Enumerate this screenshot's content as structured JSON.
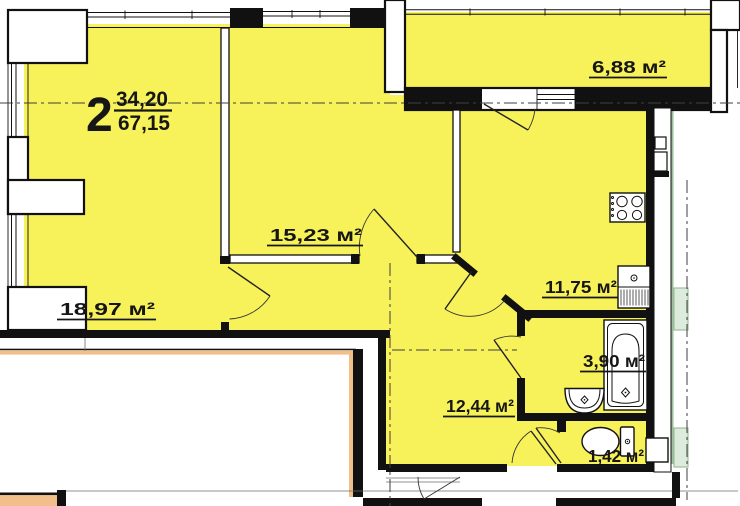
{
  "apartment": {
    "number": "2",
    "living_area": "34,20",
    "total_area": "67,15"
  },
  "rooms": [
    {
      "id": "living-room",
      "area": "18,97 м²"
    },
    {
      "id": "bedroom",
      "area": "15,23 м²"
    },
    {
      "id": "kitchen",
      "area": "11,75 м²"
    },
    {
      "id": "hallway",
      "area": "12,44 м²"
    },
    {
      "id": "bathroom",
      "area": "3,90 м²"
    },
    {
      "id": "wc",
      "area": "1,42 м²"
    },
    {
      "id": "balcony",
      "area": "6,88 м²"
    }
  ],
  "colors": {
    "room_fill": "#F7F15A",
    "wall": "#111111",
    "neighbor_outline": "#F2BE8A",
    "adjacent_fixture": "#9DBE9D"
  }
}
